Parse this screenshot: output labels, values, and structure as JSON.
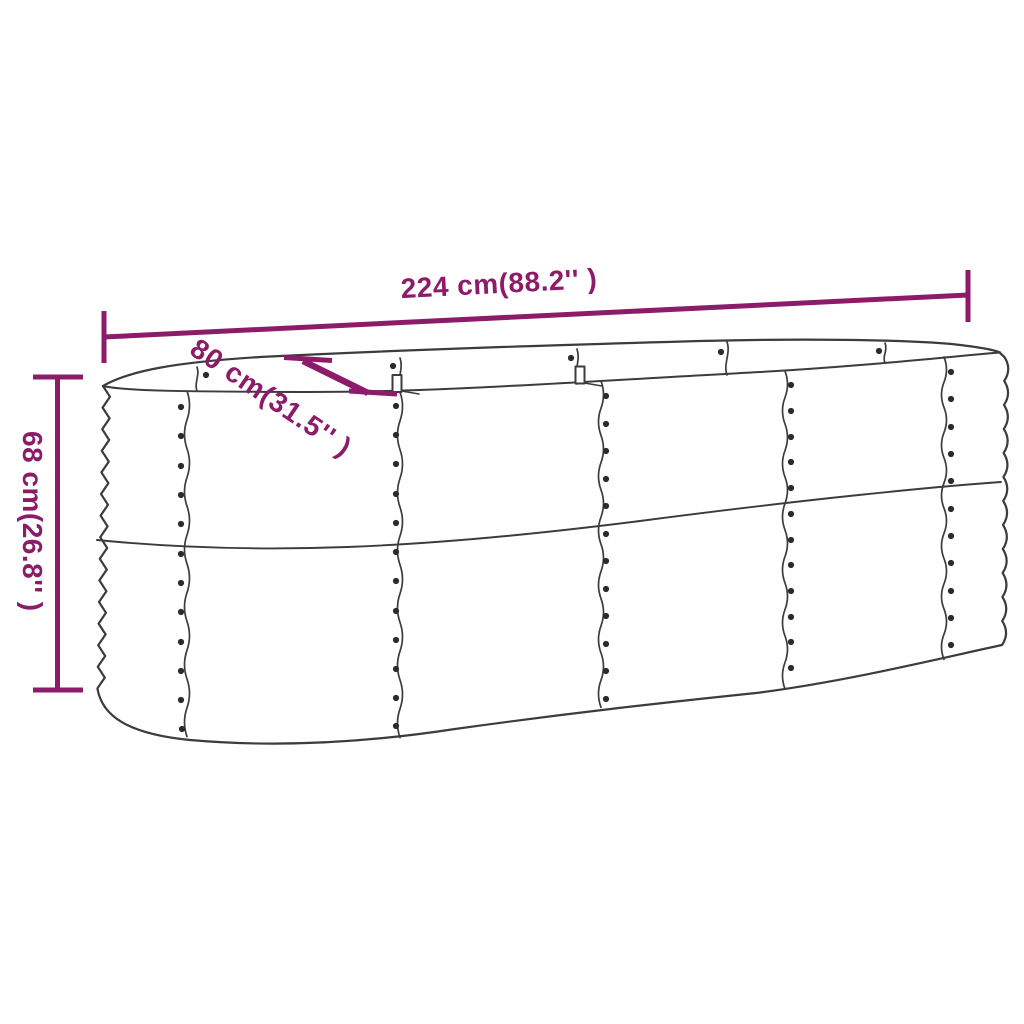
{
  "canvas": {
    "width": 1024,
    "height": 1024,
    "background": "#ffffff"
  },
  "diagram": {
    "kind": "product dimension line drawing",
    "subject": "oval corrugated-steel raised garden bed planter, three-quarter perspective",
    "colors": {
      "dimension_accent": "#8c1c69",
      "line_art": "#3c3c3c",
      "rivet": "#2b2b2b"
    },
    "dimensions": {
      "length": {
        "label": "224 cm(88.2'' )",
        "cm": "224 cm",
        "inches": "88.2''"
      },
      "width": {
        "label": "80 cm(31.5'' )",
        "cm": "80 cm",
        "inches": "31.5''"
      },
      "height": {
        "label": "68 cm(26.8'' )",
        "cm": "68 cm",
        "inches": "26.8''"
      }
    }
  }
}
